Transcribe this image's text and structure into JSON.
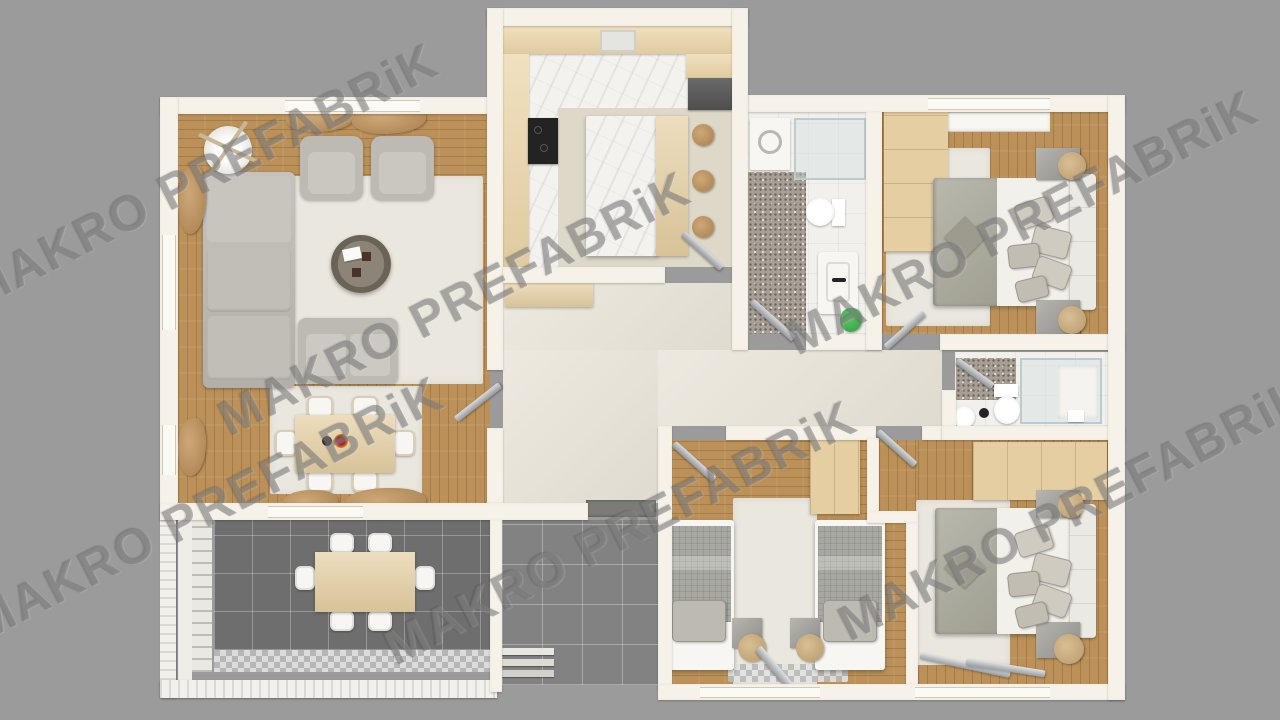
{
  "watermark": {
    "text": "MAKRO PREFABRiK"
  },
  "colors": {
    "bg": "#9b9b9b",
    "wall": "#f6f2e9",
    "wood": "#bb9159",
    "rug": "#eae7df",
    "hall": "#e7e2d6",
    "kitchenFloor": "#ddd8c8",
    "marble": "#f3f2ef",
    "counter": "#ecd6a9",
    "terrace": "#6e6e6e",
    "porch": "#828282",
    "terrazzo": "#a79f96",
    "bathFloor": "#f2f0ec",
    "gray1": "#bdbab4",
    "bedding": "#adac9e",
    "twinBedding": "#a7a8a2",
    "sheet": "#f2f0ea",
    "pillow": "#d0cbc0",
    "headboard": "#ebe9e3",
    "tan": "#e5cfa2",
    "lamp": "#d8bf94",
    "white": "#f7f6f3",
    "black": "#232323",
    "appliance": "#4e4e4e",
    "green": "#3fa84c",
    "glassFill": "rgba(208,223,224,0.4)",
    "glassEdge": "#bccccd",
    "mat": "#7c7b77",
    "wm": "rgba(118,118,118,0.5)"
  }
}
